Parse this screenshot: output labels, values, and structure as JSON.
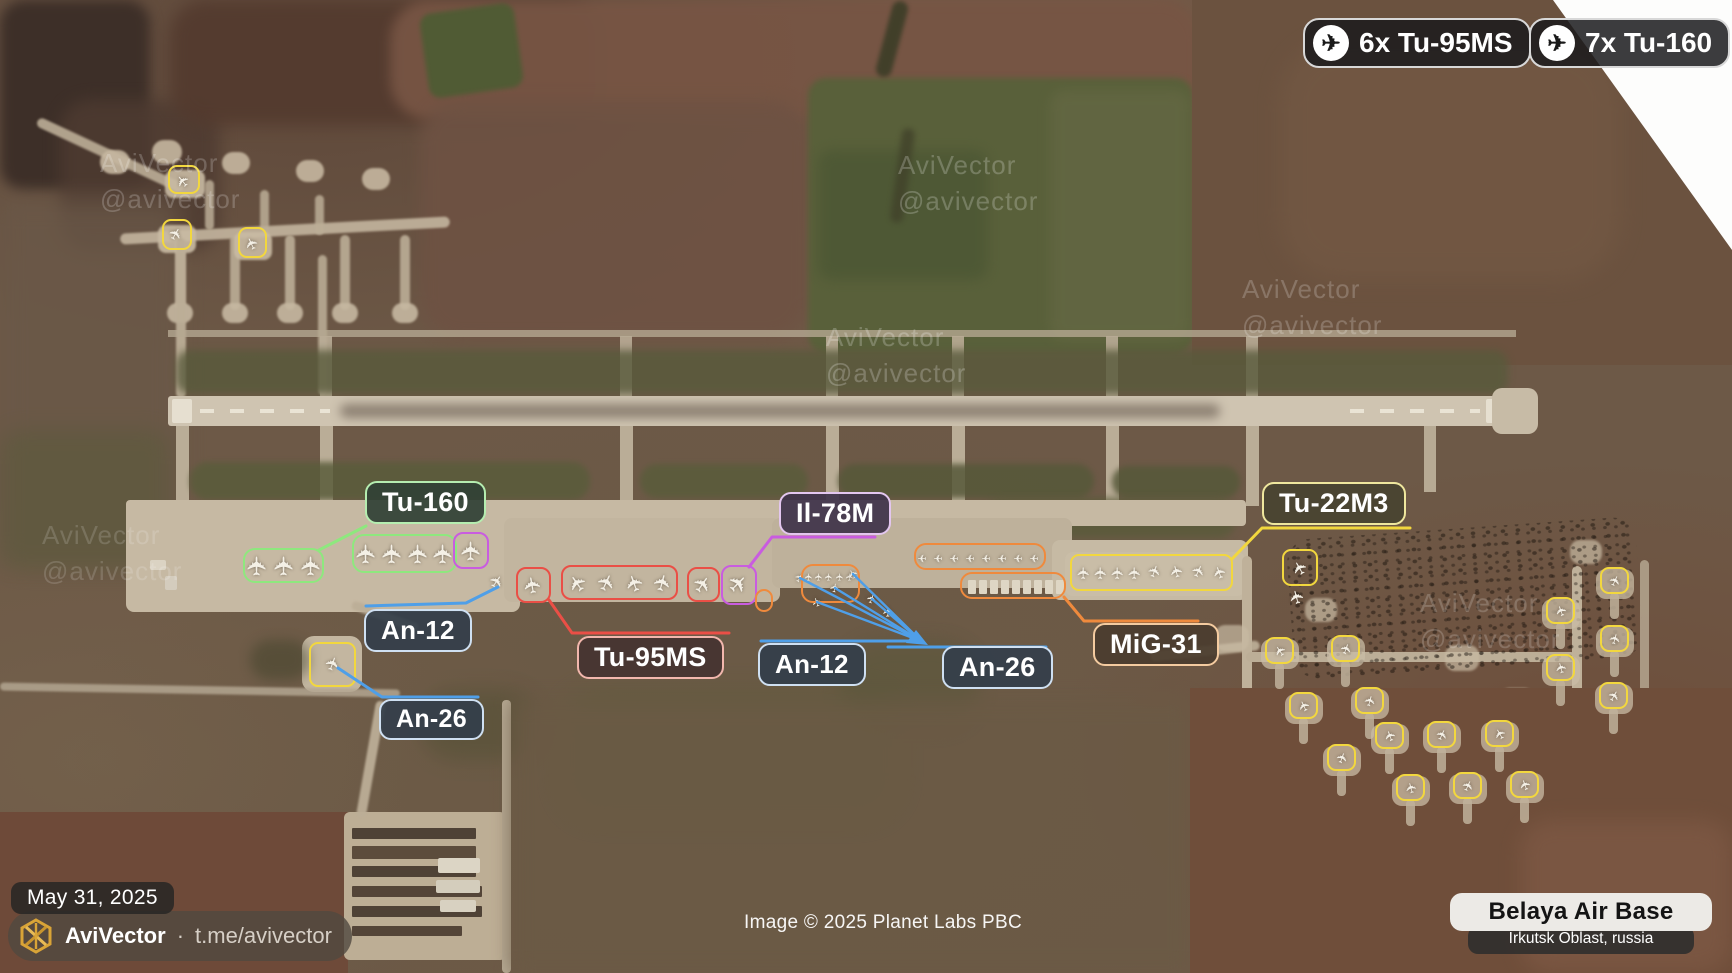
{
  "summary_badges": [
    {
      "icon": "airplane-icon",
      "label": "6x Tu-95MS"
    },
    {
      "icon": "airplane-icon",
      "label": "7x Tu-160"
    }
  ],
  "annotations": [
    {
      "label": "Tu-160",
      "color": "green"
    },
    {
      "label": "Il-78M",
      "color": "purple"
    },
    {
      "label": "Tu-22M3",
      "color": "yellow"
    },
    {
      "label": "An-12",
      "color": "blue"
    },
    {
      "label": "Tu-95MS",
      "color": "red"
    },
    {
      "label": "An-12",
      "color": "blue"
    },
    {
      "label": "An-26",
      "color": "blue"
    },
    {
      "label": "MiG-31",
      "color": "orange"
    },
    {
      "label": "An-26",
      "color": "blue"
    }
  ],
  "colors": {
    "green": "#8ee87e",
    "purple": "#c95ce0",
    "red": "#ea4f46",
    "orange": "#ef8a3d",
    "yellow": "#f2d73e",
    "blue": "#4f9fe8",
    "gold": "#d9a437"
  },
  "watermark": {
    "line1": "AviVector",
    "line2": "@avivector"
  },
  "footer": {
    "date": "May 31, 2025",
    "brand": "AviVector",
    "separator": "·",
    "handle": "t.me/avivector"
  },
  "credit": "Image © 2025 Planet Labs PBC",
  "base": {
    "name": "Belaya Air Base",
    "location": "Irkutsk Oblast, russia"
  },
  "glyphs": {
    "plane": "✈"
  }
}
